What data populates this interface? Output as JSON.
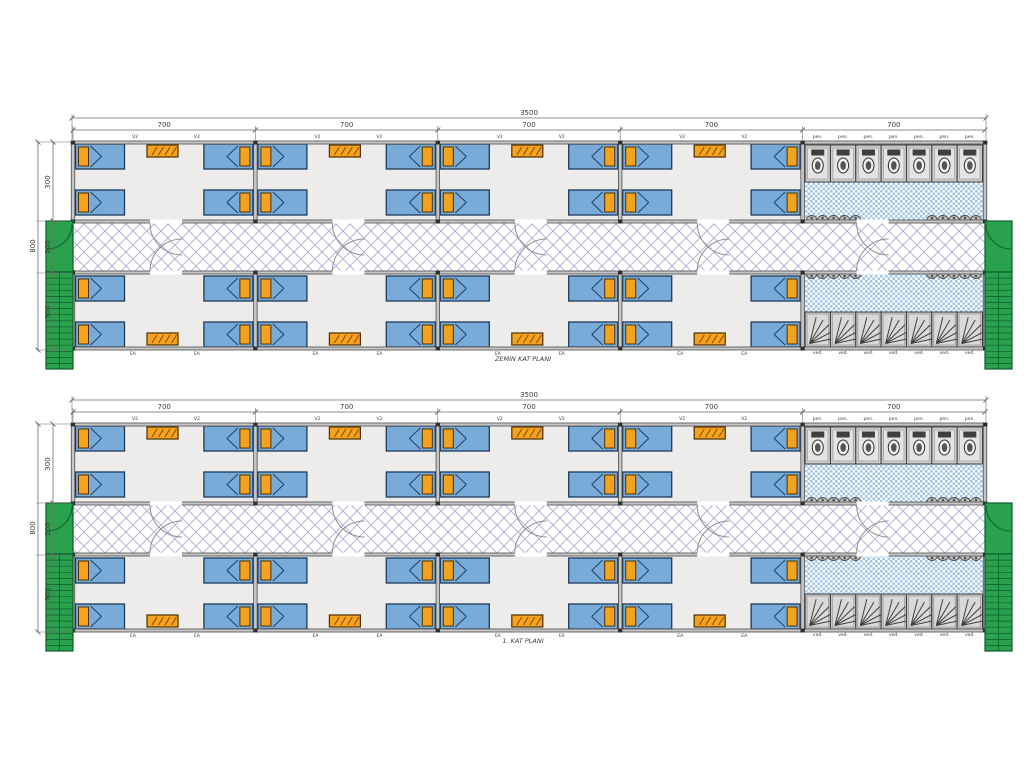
{
  "drawing": {
    "type": "container-building-floor-plan",
    "plans": [
      {
        "title": "ZEMİN KAT PLANI"
      },
      {
        "title": "1. KAT PLANI"
      }
    ],
    "dims": {
      "total_width": "3500",
      "module_width": "700",
      "height_total": "800",
      "height_segments": [
        "300",
        "200",
        "300"
      ]
    },
    "labels": {
      "window": "V2",
      "bath_window": "pen.",
      "rear_window": "EA",
      "shower_unit": "ved."
    },
    "counts": {
      "modules": 5,
      "room_modules": 4,
      "beds_per_module": 4,
      "tables_per_module": 2,
      "wc_stalls": 7,
      "shower_stalls": 7,
      "sinks_per_row": 10
    },
    "colors": {
      "bed": "#79abd9",
      "bed_border": "#1b3a5e",
      "pillow": "#f5a31e",
      "pillow_border": "#4a3000",
      "table": "#f5a31e",
      "table_border": "#4a2d00",
      "table_hatch": "#8a4a00",
      "room_floor": "#edecea",
      "corridor_line": "#a9afd4",
      "bath_check": "#a2c4e6",
      "wall": "#4d4d4d",
      "wall_fill": "#c6c6c6",
      "post": "#2e2e2e",
      "green": "#2aa14c",
      "green_dark": "#0b5e2a",
      "stall_fill": "#cdcdcd",
      "stall_inner": "#e4e4e4",
      "stall_border": "#3c3c3c",
      "fixture_dark": "#3f3f3f",
      "door": "#8f8f8f",
      "dim": "#6e6e6e",
      "text": "#3c3c3c"
    }
  }
}
